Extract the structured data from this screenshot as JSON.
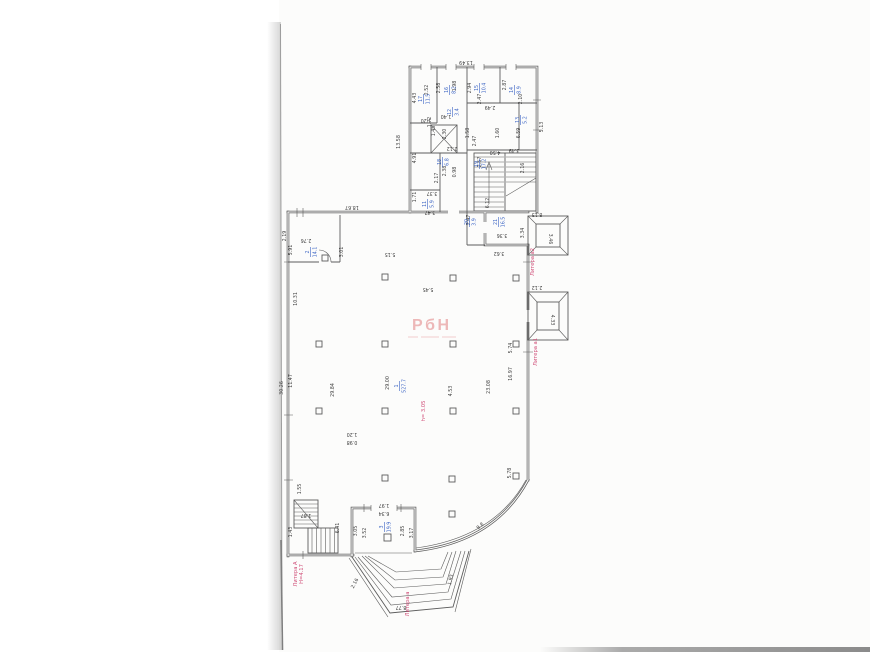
{
  "colors": {
    "paper": "#fcfcfb",
    "wall": "#5c5c5c",
    "ink": "#3f3f3f",
    "blue": "#3a63c4",
    "red": "#cf4b76",
    "wm": "#eaa8a8",
    "edge": "#a6a6a6",
    "band": "#8f8f8f"
  },
  "watermark": {
    "text": "РбН"
  },
  "plan": {
    "dims": [
      {
        "t": "13.49",
        "x": 466,
        "y": 61,
        "r": 180
      },
      {
        "t": "13.58",
        "x": 400,
        "y": 142,
        "r": -90
      },
      {
        "t": "2.19",
        "x": 286,
        "y": 236,
        "r": -90
      },
      {
        "t": "4.43",
        "x": 416,
        "y": 98,
        "r": -90
      },
      {
        "t": "2.52",
        "x": 428,
        "y": 90,
        "r": -90
      },
      {
        "t": "2.58",
        "x": 440,
        "y": 88,
        "r": -90
      },
      {
        "t": "1.98",
        "x": 456,
        "y": 86,
        "r": -90
      },
      {
        "t": "2.94",
        "x": 471,
        "y": 88,
        "r": -90
      },
      {
        "t": "2.87",
        "x": 506,
        "y": 85,
        "r": -90
      },
      {
        "t": "2.47",
        "x": 481,
        "y": 99,
        "r": -90
      },
      {
        "t": "2.10",
        "x": 522,
        "y": 99,
        "r": -90
      },
      {
        "t": "2.49",
        "x": 490,
        "y": 106,
        "r": 180
      },
      {
        "t": "1.40",
        "x": 446,
        "y": 115,
        "r": 180
      },
      {
        "t": "1.72",
        "x": 431,
        "y": 122,
        "r": -90
      },
      {
        "t": "1.20",
        "x": 426,
        "y": 119,
        "r": 180
      },
      {
        "t": "1.45",
        "x": 435,
        "y": 131,
        "r": -90
      },
      {
        "t": "2.30",
        "x": 446,
        "y": 134,
        "r": -90
      },
      {
        "t": "2.12",
        "x": 452,
        "y": 147,
        "r": 180
      },
      {
        "t": "4.91",
        "x": 416,
        "y": 158,
        "r": -90
      },
      {
        "t": "2.38",
        "x": 446,
        "y": 171,
        "r": -90
      },
      {
        "t": "0.98",
        "x": 456,
        "y": 172,
        "r": -90
      },
      {
        "t": "2.17",
        "x": 438,
        "y": 178,
        "r": -90
      },
      {
        "t": "3.37",
        "x": 432,
        "y": 192,
        "r": 180
      },
      {
        "t": "1.71",
        "x": 416,
        "y": 197,
        "r": -90
      },
      {
        "t": "3.47",
        "x": 430,
        "y": 211,
        "r": 180
      },
      {
        "t": "1.58",
        "x": 469,
        "y": 133,
        "r": -90
      },
      {
        "t": "2.47",
        "x": 476,
        "y": 141,
        "r": -90
      },
      {
        "t": "2.57",
        "x": 481,
        "y": 162,
        "r": -90
      },
      {
        "t": "1.60",
        "x": 499,
        "y": 133,
        "r": -90
      },
      {
        "t": "6.59",
        "x": 520,
        "y": 133,
        "r": -90
      },
      {
        "t": "5.13",
        "x": 543,
        "y": 127,
        "r": -90
      },
      {
        "t": "4.50",
        "x": 495,
        "y": 151,
        "r": 180
      },
      {
        "t": "3.49",
        "x": 514,
        "y": 149,
        "r": 180
      },
      {
        "t": "2.16",
        "x": 524,
        "y": 168,
        "r": -90
      },
      {
        "t": "6.12",
        "x": 489,
        "y": 203,
        "r": -90
      },
      {
        "t": "8.13",
        "x": 537,
        "y": 213,
        "r": 180
      },
      {
        "t": "2.47",
        "x": 470,
        "y": 220,
        "r": -90
      },
      {
        "t": "3.36",
        "x": 502,
        "y": 234,
        "r": 180
      },
      {
        "t": "3.62",
        "x": 499,
        "y": 252,
        "r": 180
      },
      {
        "t": "3.34",
        "x": 524,
        "y": 233,
        "r": -90
      },
      {
        "t": "18.67",
        "x": 352,
        "y": 206,
        "r": 180
      },
      {
        "t": "2.76",
        "x": 306,
        "y": 239,
        "r": 180
      },
      {
        "t": "5.91",
        "x": 292,
        "y": 250,
        "r": -90
      },
      {
        "t": "3.01",
        "x": 343,
        "y": 252,
        "r": -90
      },
      {
        "t": "10.31",
        "x": 297,
        "y": 299,
        "r": -90
      },
      {
        "t": "5.15",
        "x": 390,
        "y": 253,
        "r": 180
      },
      {
        "t": "5.45",
        "x": 428,
        "y": 288,
        "r": 180
      },
      {
        "t": "11.47",
        "x": 292,
        "y": 381,
        "r": -90
      },
      {
        "t": "30.26",
        "x": 283,
        "y": 388,
        "r": -90
      },
      {
        "t": "29.84",
        "x": 334,
        "y": 390,
        "r": -90
      },
      {
        "t": "29.00",
        "x": 389,
        "y": 383,
        "r": -90
      },
      {
        "t": "4.53",
        "x": 452,
        "y": 391,
        "r": -90
      },
      {
        "t": "23.08",
        "x": 490,
        "y": 387,
        "r": -90
      },
      {
        "t": "16.97",
        "x": 512,
        "y": 374,
        "r": -90
      },
      {
        "t": "5.74",
        "x": 512,
        "y": 348,
        "r": -90
      },
      {
        "t": "5.78",
        "x": 511,
        "y": 473,
        "r": -90
      },
      {
        "t": "1.20",
        "x": 352,
        "y": 433,
        "r": 180
      },
      {
        "t": "0.98",
        "x": 352,
        "y": 441,
        "r": 180
      },
      {
        "t": "1.55",
        "x": 301,
        "y": 489,
        "r": -90
      },
      {
        "t": "1.87",
        "x": 306,
        "y": 514,
        "r": 180
      },
      {
        "t": "1.43",
        "x": 292,
        "y": 532,
        "r": -90
      },
      {
        "t": "6.41",
        "x": 339,
        "y": 528,
        "r": -90
      },
      {
        "t": "1.97",
        "x": 384,
        "y": 504,
        "r": 180
      },
      {
        "t": "6.34",
        "x": 384,
        "y": 512,
        "r": 180
      },
      {
        "t": "3.05",
        "x": 357,
        "y": 531,
        "r": -90
      },
      {
        "t": "3.52",
        "x": 366,
        "y": 533,
        "r": -90
      },
      {
        "t": "2.85",
        "x": 404,
        "y": 531,
        "r": -90
      },
      {
        "t": "3.17",
        "x": 413,
        "y": 533,
        "r": -90
      },
      {
        "t": "9.8",
        "x": 481,
        "y": 527,
        "r": -40
      },
      {
        "t": "2.16",
        "x": 356,
        "y": 584,
        "r": -62
      },
      {
        "t": "1.93",
        "x": 452,
        "y": 580,
        "r": -78
      },
      {
        "t": "8.77",
        "x": 401,
        "y": 606,
        "r": 180
      },
      {
        "t": "3.46",
        "x": 549,
        "y": 239,
        "r": 90
      },
      {
        "t": "2.12",
        "x": 537,
        "y": 286,
        "r": 180
      },
      {
        "t": "4.33",
        "x": 551,
        "y": 320,
        "r": 90
      }
    ],
    "rooms": [
      {
        "n": "17",
        "a": "11.5",
        "x": 423,
        "y": 99,
        "r": -90
      },
      {
        "n": "16",
        "a": "8.2",
        "x": 449,
        "y": 90,
        "r": -90
      },
      {
        "n": "15",
        "a": "10.4",
        "x": 479,
        "y": 88,
        "r": -90
      },
      {
        "n": "14",
        "a": "8.9",
        "x": 514,
        "y": 90,
        "r": -90
      },
      {
        "n": "13",
        "a": "5.2",
        "x": 520,
        "y": 120,
        "r": -90
      },
      {
        "n": "12",
        "a": "3.4",
        "x": 452,
        "y": 112,
        "r": -90
      },
      {
        "n": "18",
        "a": "6.8",
        "x": 442,
        "y": 162,
        "r": -90
      },
      {
        "n": "19",
        "a": "17.2",
        "x": 479,
        "y": 164,
        "r": -90
      },
      {
        "n": "11",
        "a": "5.9",
        "x": 427,
        "y": 204,
        "r": -90
      },
      {
        "n": "20",
        "a": "3.9",
        "x": 469,
        "y": 222,
        "r": -90
      },
      {
        "n": "21",
        "a": "16.5",
        "x": 498,
        "y": 222,
        "r": -90
      },
      {
        "n": "2",
        "a": "14.1",
        "x": 310,
        "y": 252,
        "r": -90
      },
      {
        "n": "1",
        "a": "527.7",
        "x": 399,
        "y": 386,
        "r": -90
      },
      {
        "n": "3",
        "a": "19.9",
        "x": 384,
        "y": 527,
        "r": -90
      }
    ],
    "reds": [
      {
        "t": "Литера а2",
        "x": 534,
        "y": 262,
        "r": -90
      },
      {
        "t": "Литера а1",
        "x": 537,
        "y": 352,
        "r": -90
      },
      {
        "t": "Литера а",
        "x": 409,
        "y": 604,
        "r": -90
      },
      {
        "t": "Литера А",
        "t2": "Н=4.17",
        "x": 297,
        "y": 574,
        "r": -90
      },
      {
        "t": "h= 3.05",
        "x": 425,
        "y": 411,
        "r": -90
      }
    ]
  }
}
